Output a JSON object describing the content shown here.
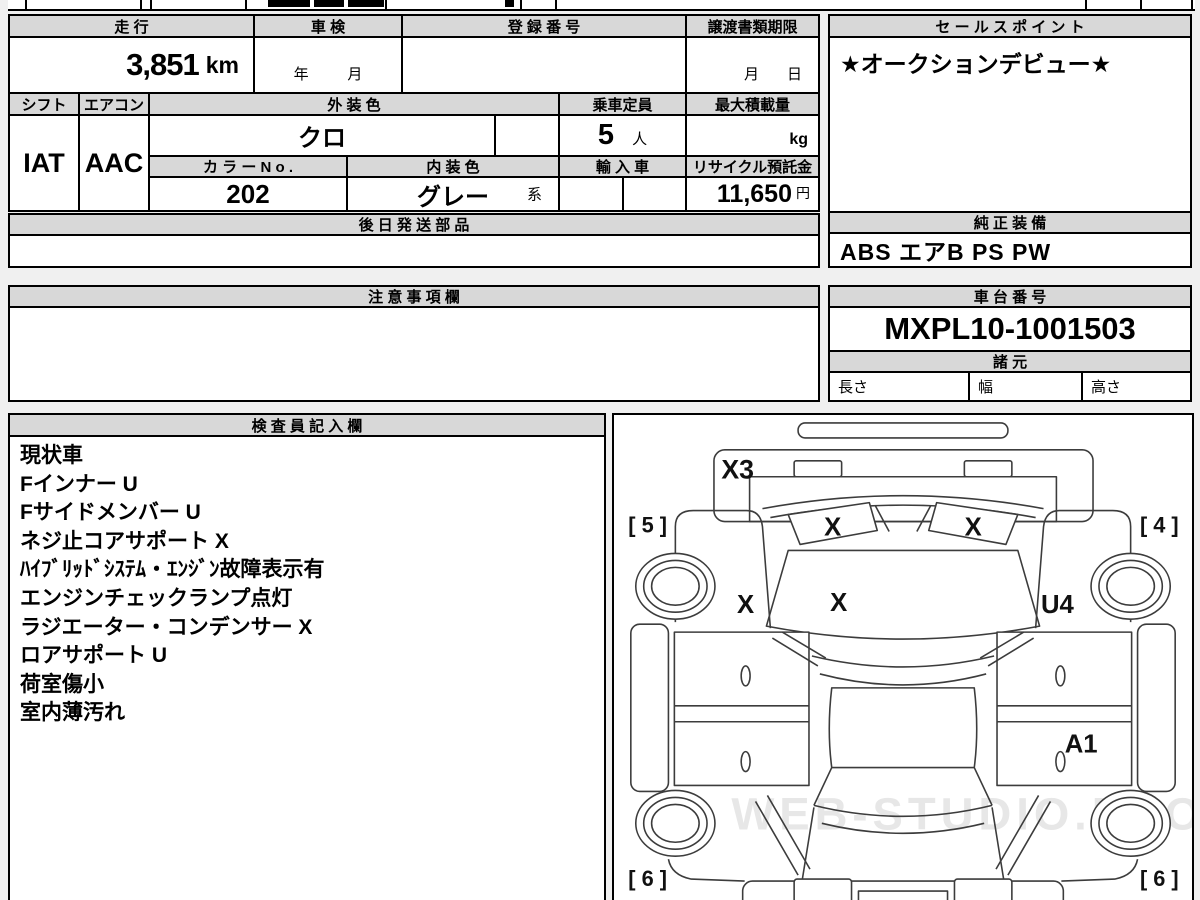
{
  "watermark": "WEB-STUDIO.PRO",
  "colors": {
    "header_bg": "#d8d8d8",
    "border": "#000000",
    "page_bg": "#f0f0f0",
    "cell_bg": "#ffffff"
  },
  "info": {
    "labels": {
      "mileage": "走 行",
      "shaken": "車 検",
      "registration": "登 録 番 号",
      "transfer_docs": "譲渡書類期限",
      "shift": "シフト",
      "aircon": "エアコン",
      "exterior_color": "外 装 色",
      "capacity": "乗車定員",
      "max_load": "最大積載量",
      "color_no": "カ ラ ー N o .",
      "interior_color": "内 装 色",
      "import_car": "輸 入 車",
      "recycle_deposit": "リサイクル預託金",
      "later_parts": "後 日 発 送 部 品",
      "caution": "注 意 事 項 欄",
      "sales_point": "セ ー ル ス ポ イ ン ト",
      "genuine_equipment": "純 正 装 備",
      "chassis_no": "車 台 番 号",
      "specs": "諸 元",
      "length": "長さ",
      "width": "幅",
      "height": "高さ",
      "inspector": "検 査 員 記 入 欄"
    },
    "values": {
      "mileage": "3,851",
      "mileage_unit": "km",
      "shaken_year": "年",
      "shaken_month": "月",
      "transfer_month": "月",
      "transfer_day": "日",
      "shift": "IAT",
      "aircon": "AAC",
      "exterior_color": "クロ",
      "capacity": "5",
      "capacity_unit": "人",
      "max_load_unit": "kg",
      "color_no": "202",
      "interior_color": "グレー",
      "interior_suffix": "系",
      "recycle_deposit": "11,650",
      "recycle_unit": "円",
      "sales_point": "★オークションデビュー★",
      "genuine_equipment": "ABS エアB PS PW",
      "chassis_no": "MXPL10-1001503"
    }
  },
  "inspector_notes": [
    "現状車",
    "Fインナー U",
    "Fサイドメンバー U",
    "ネジ止コアサポート X",
    "ﾊｲﾌﾞﾘｯﾄﾞｼｽﾃﾑ・ｴﾝｼﾞﾝ故障表示有",
    "エンジンチェックランプ点灯",
    "ラジエーター・コンデンサー X",
    "ロアサポート U",
    "荷室傷小",
    "室内薄汚れ"
  ],
  "diagram": {
    "marks": {
      "front_bumper": "X3",
      "headlight_left": "X",
      "headlight_right": "X",
      "hood": "X",
      "fender_left": "X",
      "fender_right": "U4",
      "rear_quarter_right": "A1"
    },
    "corners": {
      "front_left": "[ 5 ]",
      "front_right": "[ 4 ]",
      "rear_left": "[ 6 ]",
      "rear_right": "[ 6 ]"
    }
  }
}
